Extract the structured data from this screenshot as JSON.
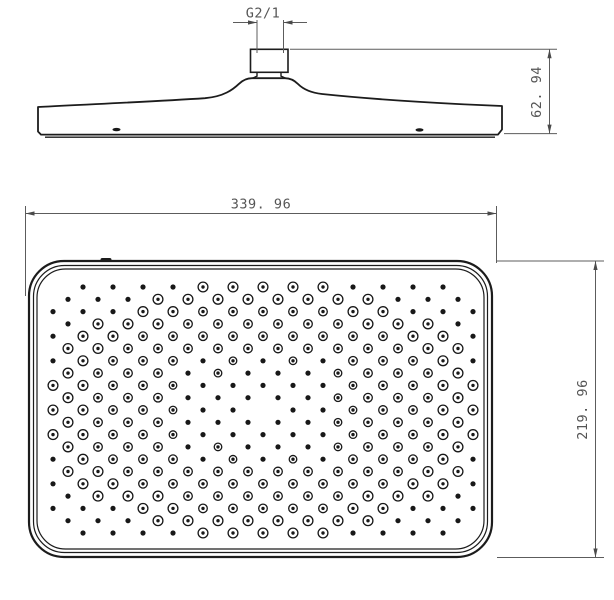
{
  "drawing": {
    "title": "shower-head-technical-drawing",
    "background_color": "#ffffff",
    "outline_color": "#1c1c1c",
    "dimension_color": "#5c5c5c",
    "labels": {
      "thread_size": "G2/1",
      "side_height": "62. 94",
      "face_width": "339. 96",
      "face_height": "219. 96"
    },
    "nozzles": {
      "color": "#181818",
      "y_start": 287,
      "row_spacing": 12.3,
      "rows": 21,
      "x_start_even": 53,
      "x_start_odd": 68,
      "col_spacing": 30,
      "x_max": 474,
      "center_x": 263,
      "center_y": 410,
      "half_w": 210,
      "half_h": 123,
      "skip_center_radius": 9,
      "ring_band_min": 0.5,
      "ring_band_max": 1.06,
      "alt_band_min": 0.34,
      "clip_x": 47,
      "clip_y": 280,
      "clip_w": 428,
      "clip_h": 259,
      "clip_r": 30,
      "solid_r": 2.6,
      "ring_r": 4.3,
      "ring_r_outer": 4.9,
      "ring_dot_r": 1.7,
      "ring_stroke": 1.3
    }
  }
}
